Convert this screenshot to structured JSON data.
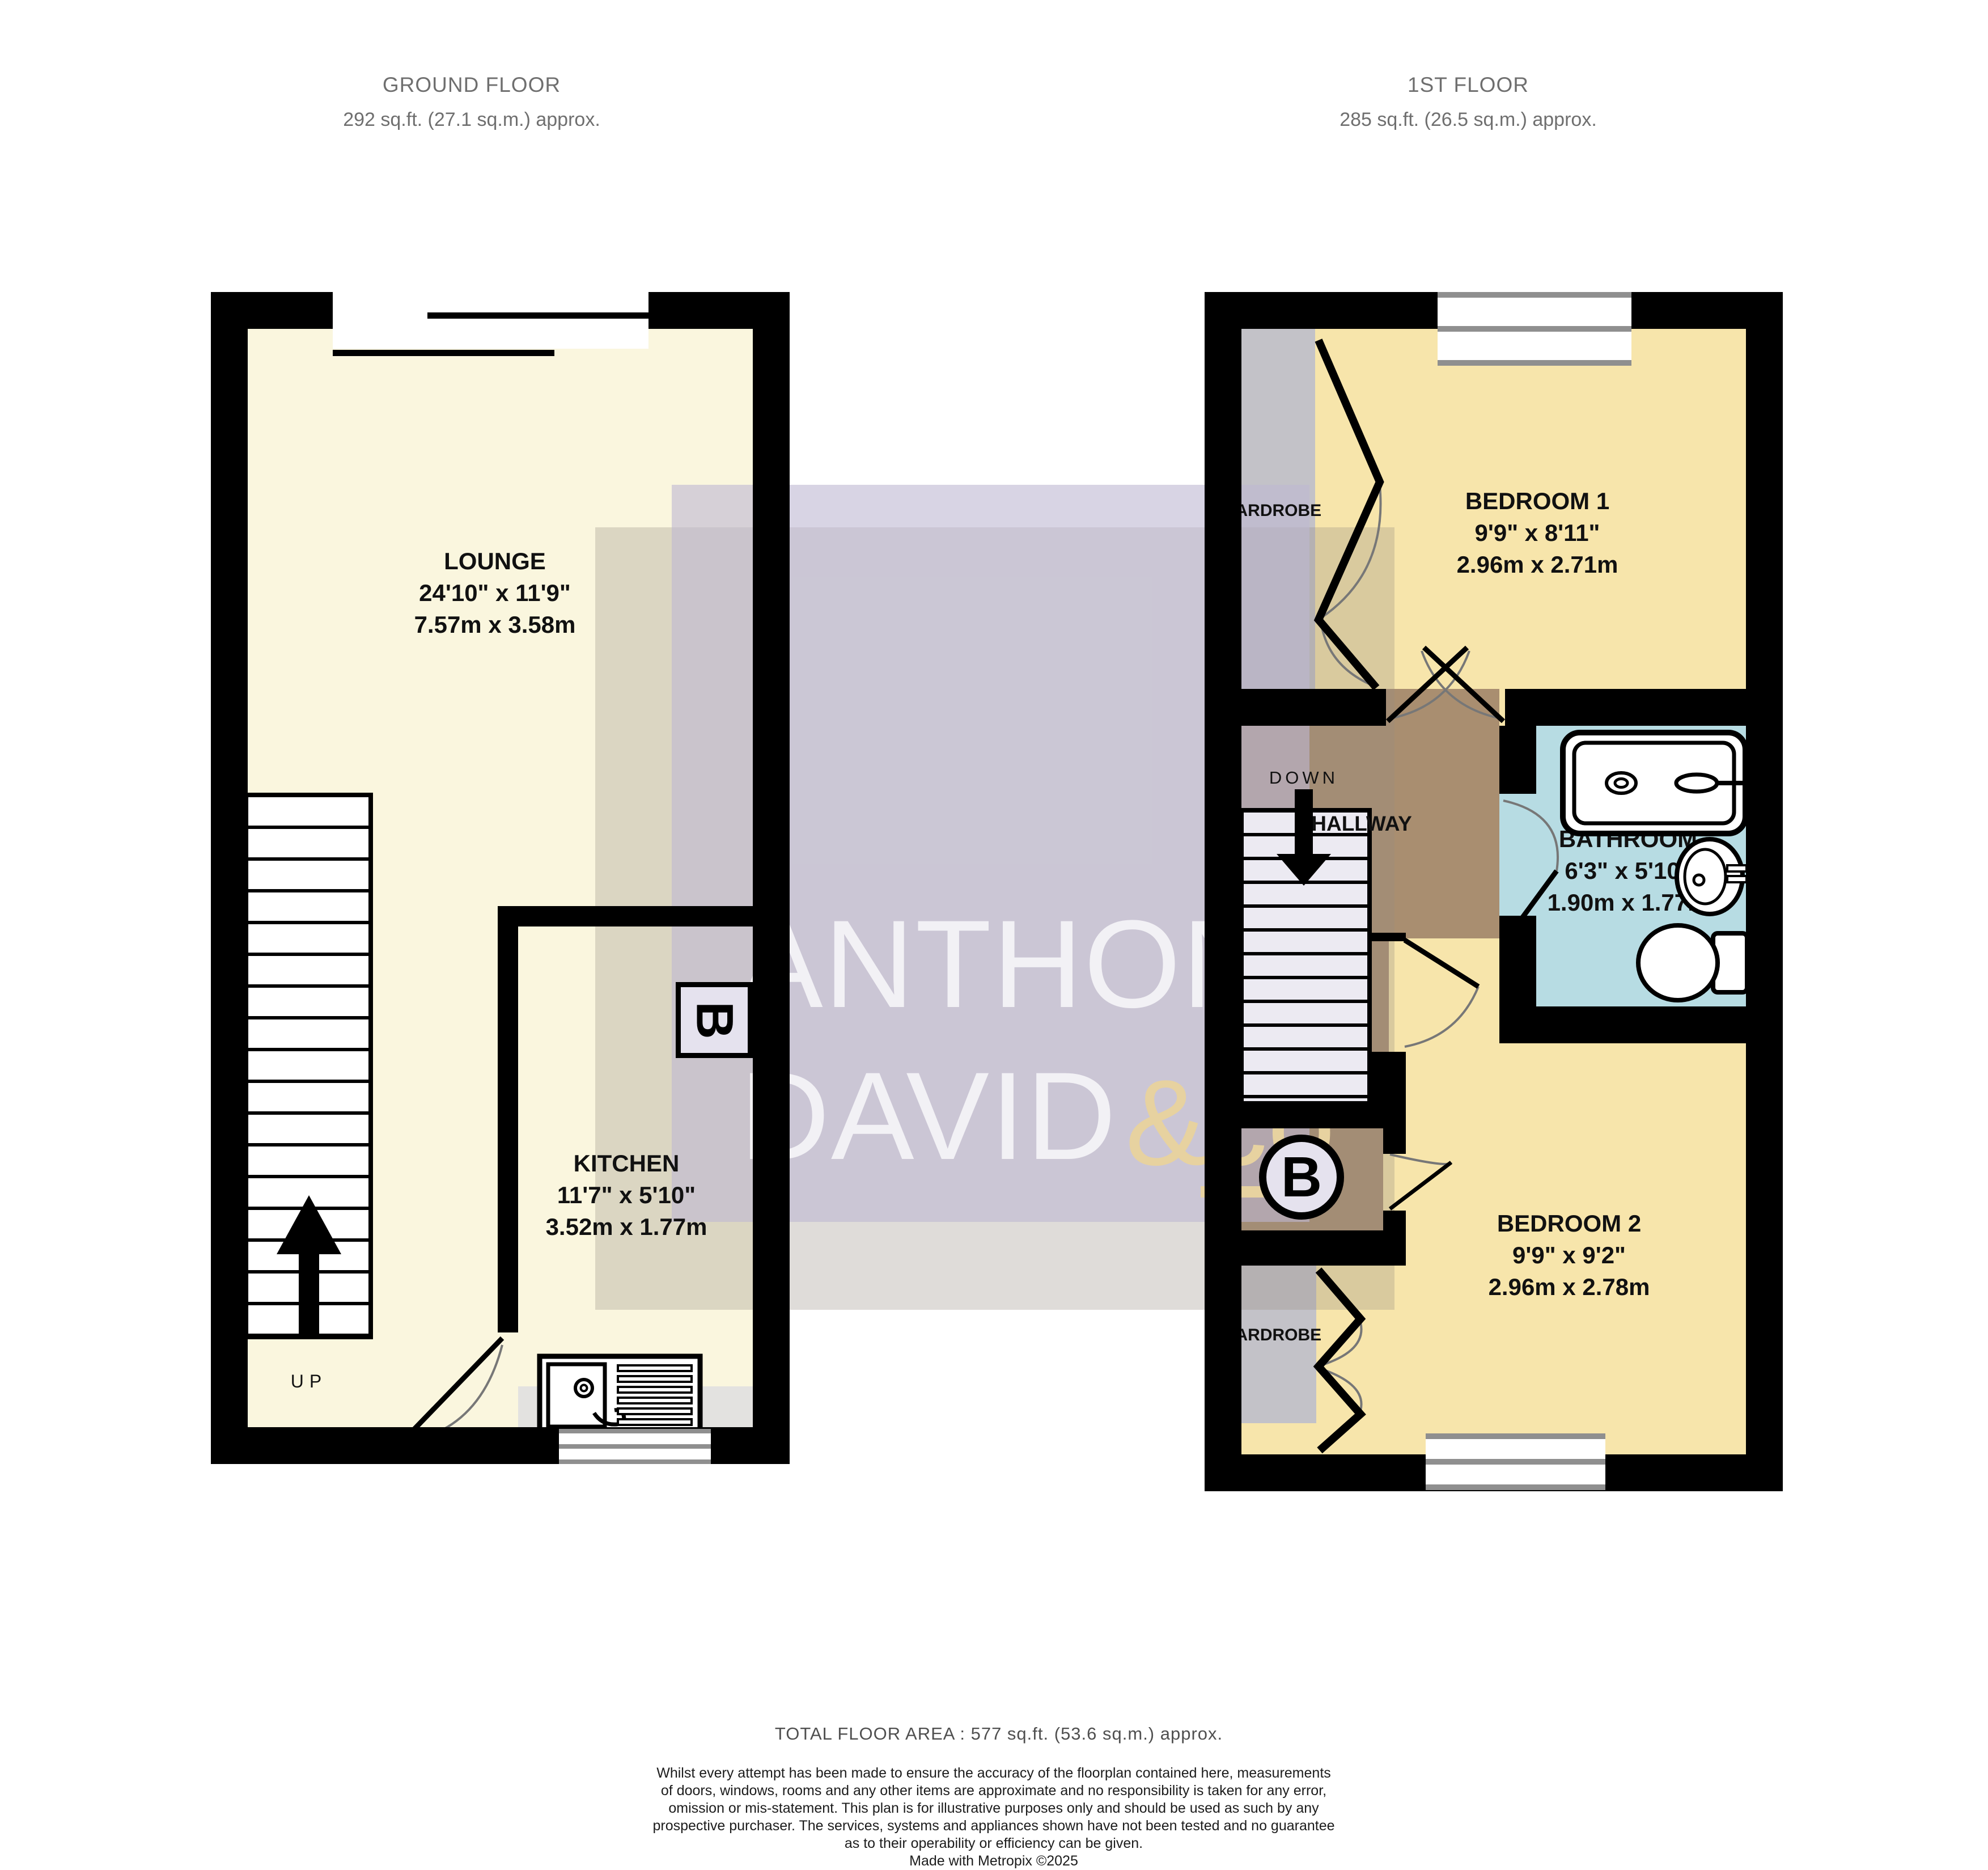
{
  "colors": {
    "floor_cream": "#faf6de",
    "bedroom_yellow": "#f7e5ab",
    "bathroom_blue": "#b7dce3",
    "hallway_brown": "#a98e70",
    "wardrobe_gray": "#c3c2c8",
    "counter_gray": "#e3e2e0",
    "stair_lavender": "#eceaf2",
    "boiler_fill": "#e5e2ee",
    "watermark_lavender": "rgba(190,184,210,0.60)",
    "watermark_tan": "rgba(150,140,128,0.30)",
    "watermark_text": "rgba(255,255,255,0.75)",
    "watermark_gold": "#e7d2a0",
    "wall_black": "#000000",
    "label_dark": "#111111",
    "header_gray": "#6f6f6f",
    "footer_gray": "#4f4f4f"
  },
  "header": {
    "ground_title": "GROUND FLOOR",
    "ground_area": "292 sq.ft. (27.1 sq.m.) approx.",
    "first_title": "1ST FLOOR",
    "first_area": "285 sq.ft. (26.5 sq.m.) approx."
  },
  "ground": {
    "lounge_name": "LOUNGE",
    "lounge_imperial": "24'10\"  x 11'9\"",
    "lounge_metric": "7.57m  x 3.58m",
    "kitchen_name": "KITCHEN",
    "kitchen_imperial": "11'7\"  x 5'10\"",
    "kitchen_metric": "3.52m  x 1.77m",
    "up": "UP",
    "boiler": "B"
  },
  "first": {
    "bed1_name": "BEDROOM 1",
    "bed1_imperial": "9'9\"  x 8'11\"",
    "bed1_metric": "2.96m  x 2.71m",
    "bed2_name": "BEDROOM 2",
    "bed2_imperial": "9'9\"  x 9'2\"",
    "bed2_metric": "2.96m  x 2.78m",
    "bath_name": "BATHROOM",
    "bath_imperial": "6'3\"  x 5'10\"",
    "bath_metric": "1.90m  x 1.77m",
    "hallway": "HALLWAY",
    "down": "DOWN",
    "wardrobe_top": "WARDROBE",
    "wardrobe_bottom": "WARDROBE",
    "boiler": "B"
  },
  "watermark": {
    "word1": "ANTHONY",
    "word2": "DAVID",
    "word3": "&co"
  },
  "footer": {
    "total": "TOTAL FLOOR AREA : 577 sq.ft. (53.6 sq.m.) approx.",
    "lines": [
      "Whilst every attempt has been made to ensure the accuracy of the floorplan contained here, measurements",
      "of doors, windows, rooms and any other items are approximate and no responsibility is taken for any error,",
      "omission or mis-statement. This plan is for illustrative purposes only and should be used as such by any",
      "prospective purchaser. The services, systems and appliances shown have not been tested and no guarantee",
      "as to their operability or efficiency can be given.",
      "Made with Metropix ©2025"
    ]
  }
}
